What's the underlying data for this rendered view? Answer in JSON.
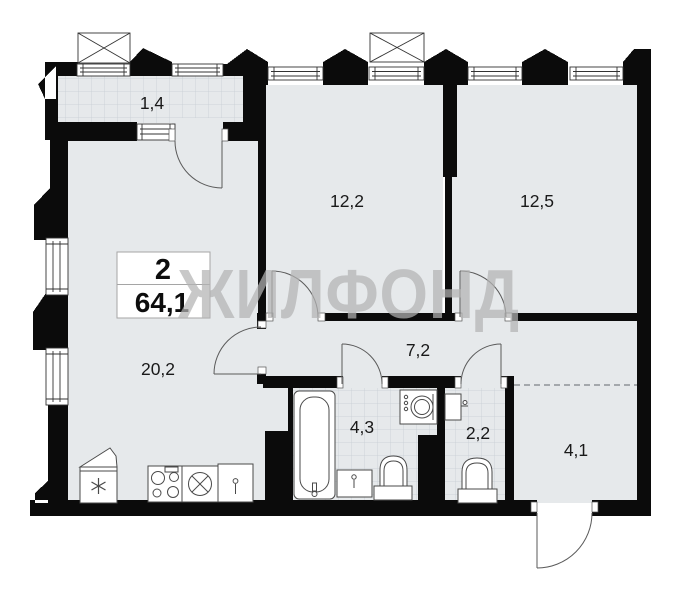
{
  "plan": {
    "watermark": "ЖИЛФОНД",
    "summary": {
      "rooms_count": "2",
      "total_area": "64,1"
    },
    "rooms": [
      {
        "id": "balcony",
        "label": "1,4"
      },
      {
        "id": "bedroom-1",
        "label": "12,2"
      },
      {
        "id": "bedroom-2",
        "label": "12,5"
      },
      {
        "id": "living-kitchen",
        "label": "20,2"
      },
      {
        "id": "hallway",
        "label": "7,2"
      },
      {
        "id": "bathroom",
        "label": "4,3"
      },
      {
        "id": "wc",
        "label": "2,2"
      },
      {
        "id": "entry-hall",
        "label": "4,1"
      }
    ],
    "fixtures": [
      "bathtub",
      "washing-machine",
      "bathroom-sink",
      "bathroom-toilet",
      "wc-sink",
      "wc-toilet",
      "fridge",
      "stove",
      "kitchen-sink",
      "kitchen-cabinet",
      "exterior-unit",
      "exterior-unit"
    ],
    "colors": {
      "wall": "#0b0b0b",
      "floor": "#e6e9eb",
      "tile_line": "#c7cdd3",
      "watermark": "#b3b3b3",
      "door_line": "#5a5a5a"
    }
  }
}
